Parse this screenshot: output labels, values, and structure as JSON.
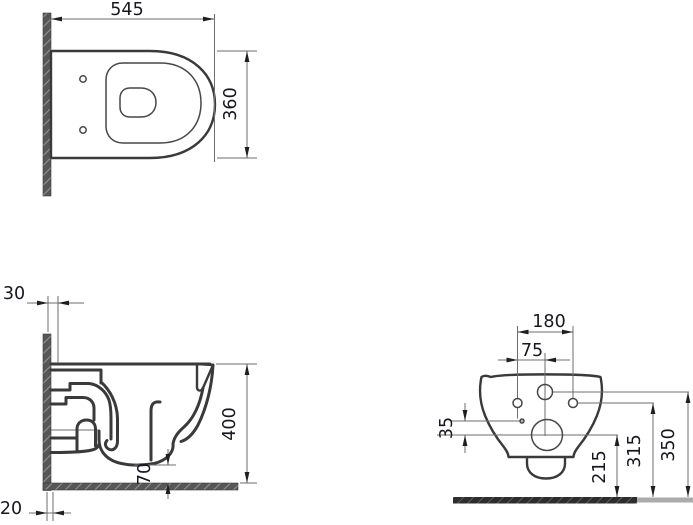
{
  "drawing": {
    "ink_color": "#3a3a3a",
    "dimension_line_color": "#6e6e6e",
    "wall_hatch_color": "#575757",
    "floor_hatch_color": "#2d2d2d",
    "views": {
      "top_view": {
        "overall_depth": "545",
        "overall_width": "360"
      },
      "side_view": {
        "wall_clearance": "30",
        "floor_strip": "20",
        "rim_height": "400",
        "trap_bottom_clearance": "70"
      },
      "rear_view": {
        "fixing_hole_spacing": "180",
        "center_to_fixing_hole": "75",
        "inlet_to_outlet_drop": "35",
        "outlet_height": "215",
        "fixing_hole_height": "315",
        "inlet_height": "350"
      }
    }
  }
}
